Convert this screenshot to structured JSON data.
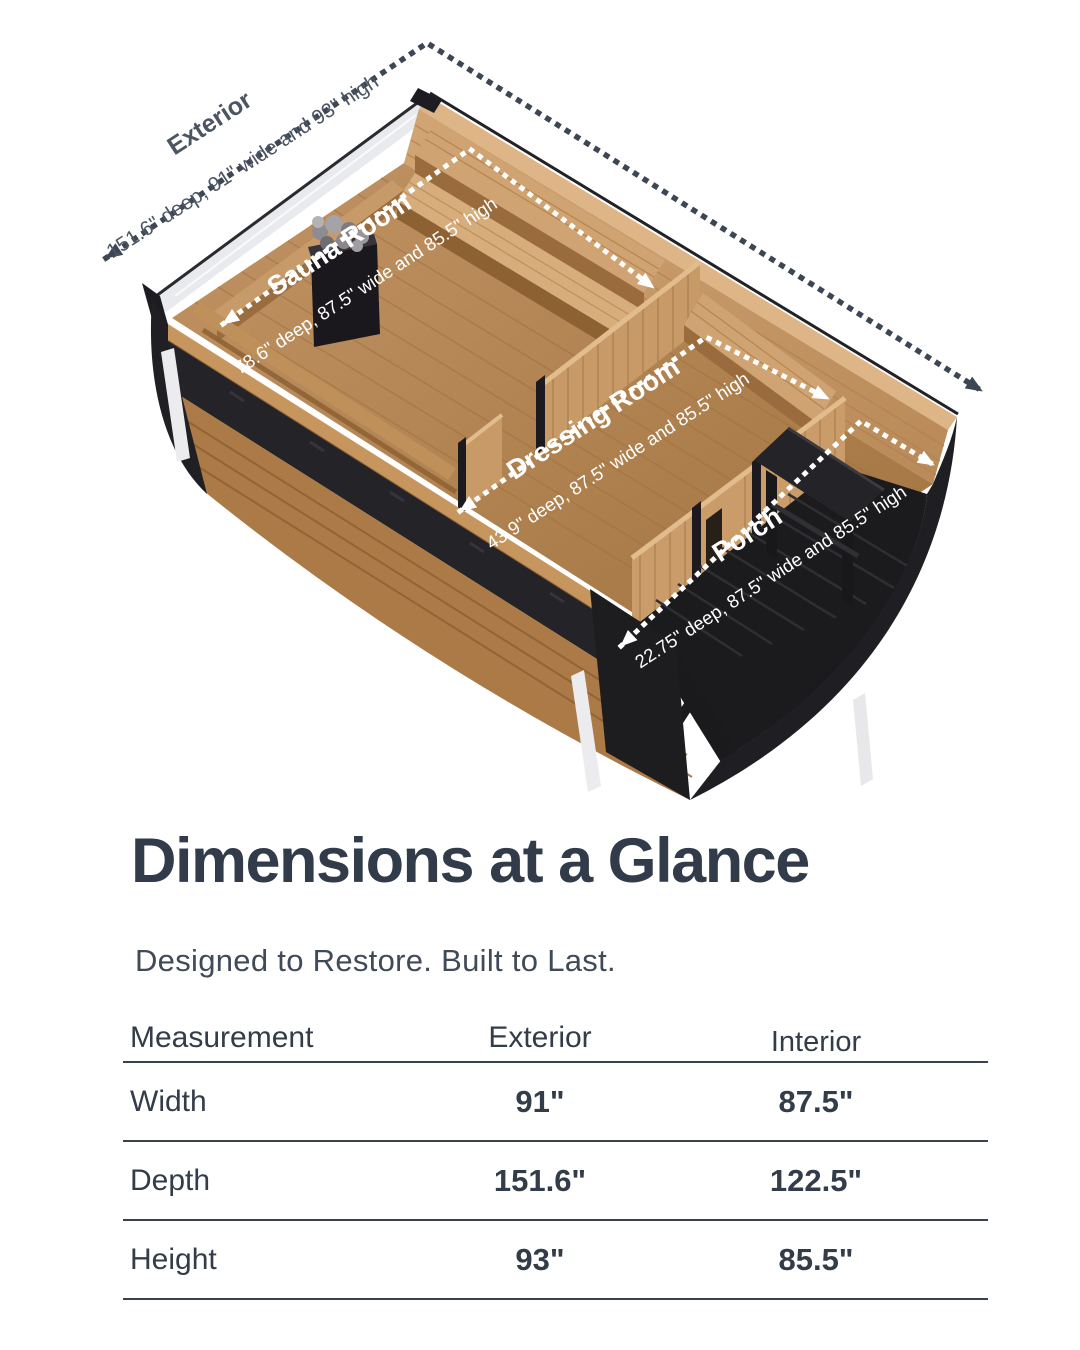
{
  "diagram": {
    "exterior_label": {
      "name": "Exterior",
      "specs": "151.6\" deep, 91\" wide and 93\" high"
    },
    "rooms": [
      {
        "name": "Sauna Room",
        "specs": "78.6\" deep, 87.5\" wide and 85.5\" high"
      },
      {
        "name": "Dressing Room",
        "specs": "43.9\" deep, 87.5\" wide and 85.5\" high"
      },
      {
        "name": "Porch",
        "specs": "22.75\" deep, 87.5\" wide and 85.5\" high"
      }
    ],
    "colors": {
      "arrow_dark": "#3d4654",
      "arrow_white": "#ffffff",
      "hull_black": "#1f1f23",
      "wood_light": "#d0a372",
      "wood_mid": "#b98a58"
    }
  },
  "heading": {
    "title": "Dimensions at a Glance",
    "subtitle": "Designed to Restore. Built to Last."
  },
  "table": {
    "headers": [
      "Measurement",
      "Exterior",
      "Interior"
    ],
    "rows": [
      {
        "label": "Width",
        "exterior": "91\"",
        "interior": "87.5\""
      },
      {
        "label": "Depth",
        "exterior": "151.6\"",
        "interior": "122.5\""
      },
      {
        "label": "Height",
        "exterior": "93\"",
        "interior": "85.5\""
      }
    ]
  }
}
